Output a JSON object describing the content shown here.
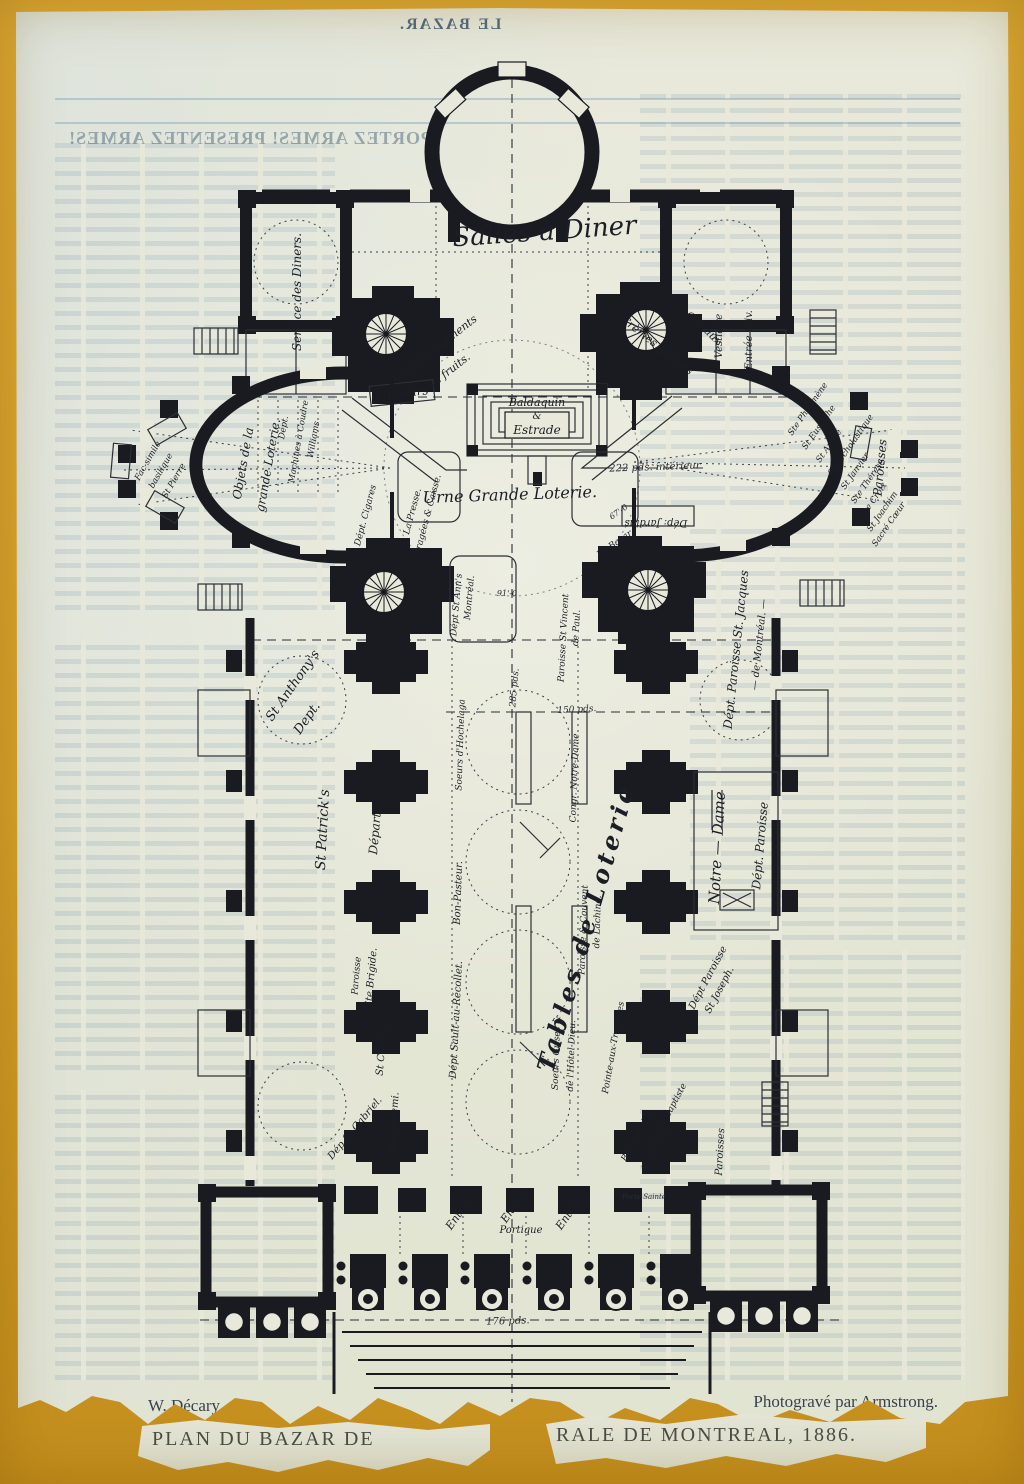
{
  "artwork": {
    "ghost_masthead": "LE BAZAR.",
    "ghost_headline": "PORTEZ ARMES! PRESENTEZ ARMES!",
    "caption": {
      "artist": "W. Décary.",
      "credit": "Photogravé par Armstrong.",
      "title_left": "PLAN DU BAZAR DE",
      "title_right": "RALE DE MONTREAL, 1886."
    }
  },
  "colors": {
    "board": "#d6a22b",
    "paper": "#e8e9da",
    "ink": "#191b21",
    "ghost_text": "#6d94ad"
  },
  "plan": {
    "labels": [
      {
        "id": "salles-a-diner",
        "t": "Salles à Diner",
        "x": 545,
        "y": 240,
        "r": -4,
        "s": 26
      },
      {
        "id": "service-des-diners",
        "t": "Service des Diners.",
        "x": 301,
        "y": 292,
        "r": -90,
        "s": 12
      },
      {
        "id": "rafraichissements",
        "t": "Rafraîchissements",
        "x": 437,
        "y": 352,
        "r": -38,
        "s": 11
      },
      {
        "id": "et-fruits",
        "t": "et fruits.",
        "x": 452,
        "y": 373,
        "r": -38,
        "s": 11
      },
      {
        "id": "liqueurs",
        "t": "Liqueurs",
        "x": 402,
        "y": 397,
        "r": -6,
        "s": 12
      },
      {
        "id": "cremes-glacees",
        "t": "Crèmes glacées",
        "x": 655,
        "y": 348,
        "r": 38,
        "s": 11
      },
      {
        "id": "gateaux",
        "t": "gâteaux",
        "x": 702,
        "y": 330,
        "r": 45,
        "s": 11
      },
      {
        "id": "vestiaire",
        "t": "Vestiaire",
        "x": 722,
        "y": 336,
        "r": -90,
        "s": 10
      },
      {
        "id": "entree-privee",
        "t": "Entrée priv.",
        "x": 752,
        "y": 340,
        "r": -90,
        "s": 10
      },
      {
        "id": "baldaquin",
        "t": "Baldaquin",
        "x": 537,
        "y": 406,
        "r": 0,
        "s": 11
      },
      {
        "id": "baldaquin-et",
        "t": "&",
        "x": 537,
        "y": 419,
        "r": 0,
        "s": 10
      },
      {
        "id": "estrade",
        "t": "Estrade",
        "x": 537,
        "y": 434,
        "r": 0,
        "s": 12
      },
      {
        "id": "dim-222",
        "t": "222 pds. intérieur",
        "x": 655,
        "y": 470,
        "r": -2,
        "s": 10,
        "c": "dim"
      },
      {
        "id": "urne-grande-loterie",
        "t": "Urne Grande Loterie.",
        "x": 510,
        "y": 500,
        "r": -2,
        "s": 16
      },
      {
        "id": "facsimile-1",
        "t": "Fac-simile",
        "x": 150,
        "y": 462,
        "r": -60,
        "s": 8.5
      },
      {
        "id": "facsimile-2",
        "t": "basilique",
        "x": 163,
        "y": 472,
        "r": -60,
        "s": 8.5
      },
      {
        "id": "facsimile-3",
        "t": "St Pierre",
        "x": 176,
        "y": 482,
        "r": -60,
        "s": 8.5
      },
      {
        "id": "objets-1",
        "t": "Objets de la",
        "x": 247,
        "y": 464,
        "r": -80,
        "s": 12
      },
      {
        "id": "objets-2",
        "t": "grande Loterie.",
        "x": 272,
        "y": 466,
        "r": -80,
        "s": 12
      },
      {
        "id": "machines-1",
        "t": "Dépt.",
        "x": 286,
        "y": 428,
        "r": -80,
        "s": 8.5
      },
      {
        "id": "machines-2",
        "t": "Machines à Coudre",
        "x": 301,
        "y": 442,
        "r": -80,
        "s": 8.5
      },
      {
        "id": "machines-3",
        "t": "Williams",
        "x": 316,
        "y": 440,
        "r": -80,
        "s": 8.5
      },
      {
        "id": "cigares",
        "t": "Dépt. Cigares",
        "x": 368,
        "y": 516,
        "r": -75,
        "s": 9
      },
      {
        "id": "presse-1",
        "t": "La Presse.",
        "x": 415,
        "y": 512,
        "r": -75,
        "s": 9
      },
      {
        "id": "presse-2",
        "t": "Dragées & Caisse.",
        "x": 430,
        "y": 516,
        "r": -75,
        "s": 9
      },
      {
        "id": "st-anns-1",
        "t": "Dépt St Ann's",
        "x": 459,
        "y": 605,
        "r": -85,
        "s": 9
      },
      {
        "id": "st-anns-2",
        "t": "Montréal.",
        "x": 472,
        "y": 598,
        "r": -85,
        "s": 9
      },
      {
        "id": "le-bazar",
        "t": "Le Bazar",
        "x": 616,
        "y": 546,
        "r": -35,
        "s": 9
      },
      {
        "id": "dep-jardins",
        "t": "Dép: Jardins",
        "x": 656,
        "y": 520,
        "r": 180,
        "s": 10
      },
      {
        "id": "dim-67",
        "t": "67'-0",
        "x": 620,
        "y": 514,
        "r": -35,
        "s": 8,
        "c": "dim"
      },
      {
        "id": "dim-91",
        "t": "91'-0",
        "x": 507,
        "y": 596,
        "r": 0,
        "s": 8,
        "c": "dim"
      },
      {
        "id": "paroisses-right",
        "t": "Paroisses",
        "x": 884,
        "y": 468,
        "r": -85,
        "s": 12
      },
      {
        "id": "paroisse-1",
        "t": "Ste Philomène",
        "x": 792,
        "y": 436,
        "r": -55,
        "s": 8.5,
        "a": "s"
      },
      {
        "id": "paroisse-2",
        "t": "St Eustache",
        "x": 806,
        "y": 450,
        "r": -55,
        "s": 8.5,
        "a": "s"
      },
      {
        "id": "paroisse-3",
        "t": "St André",
        "x": 820,
        "y": 463,
        "r": -55,
        "s": 8.5,
        "a": "s"
      },
      {
        "id": "paroisse-4",
        "t": "Ste Scholastique",
        "x": 832,
        "y": 476,
        "r": -55,
        "s": 8.5,
        "a": "s"
      },
      {
        "id": "paroisse-5",
        "t": "St Janvier",
        "x": 845,
        "y": 490,
        "r": -55,
        "s": 8.5,
        "a": "s"
      },
      {
        "id": "paroisse-6",
        "t": "Ste Thérèse",
        "x": 855,
        "y": 504,
        "r": -55,
        "s": 8.5,
        "a": "s"
      },
      {
        "id": "paroisse-7",
        "t": "Ste Croix",
        "x": 864,
        "y": 518,
        "r": -55,
        "s": 8.5,
        "a": "s"
      },
      {
        "id": "paroisse-8",
        "t": "St Joachim",
        "x": 871,
        "y": 532,
        "r": -55,
        "s": 8.5,
        "a": "s"
      },
      {
        "id": "paroisse-9",
        "t": "Sacré Cœur",
        "x": 876,
        "y": 547,
        "r": -55,
        "s": 8.5,
        "a": "s"
      },
      {
        "id": "dim-285",
        "t": "285 pds.",
        "x": 517,
        "y": 688,
        "r": -85,
        "s": 9,
        "c": "dim"
      },
      {
        "id": "dim-150",
        "t": "150 pds.",
        "x": 577,
        "y": 712,
        "r": -3,
        "s": 9,
        "c": "dim"
      },
      {
        "id": "st-vincent-1",
        "t": "Paroisse St Vincent",
        "x": 566,
        "y": 638,
        "r": -87,
        "s": 9
      },
      {
        "id": "st-vincent-2",
        "t": "de Paul.",
        "x": 579,
        "y": 628,
        "r": -87,
        "s": 9
      },
      {
        "id": "st-jacques-1",
        "t": "Dépt. Paroisse St. Jacques",
        "x": 740,
        "y": 650,
        "r": -84,
        "s": 12
      },
      {
        "id": "st-jacques-2",
        "t": "— de Montréal. —",
        "x": 762,
        "y": 645,
        "r": -84,
        "s": 10
      },
      {
        "id": "st-anthonys-1",
        "t": "St Anthony's",
        "x": 272,
        "y": 722,
        "r": -55,
        "s": 13,
        "a": "s"
      },
      {
        "id": "st-anthonys-2",
        "t": "Dept.",
        "x": 300,
        "y": 735,
        "r": -55,
        "s": 13,
        "a": "s"
      },
      {
        "id": "soeurs-hochelaga",
        "t": "Soeurs d'Hochelaga",
        "x": 463,
        "y": 745,
        "r": -88,
        "s": 9
      },
      {
        "id": "congr-notre-dame",
        "t": "Congr. Notre-Dame",
        "x": 577,
        "y": 778,
        "r": -88,
        "s": 9
      },
      {
        "id": "st-patricks",
        "t": "St Patrick's",
        "x": 327,
        "y": 830,
        "r": -87,
        "s": 14
      },
      {
        "id": "depart",
        "t": "Départ.",
        "x": 379,
        "y": 832,
        "r": -85,
        "s": 12
      },
      {
        "id": "bon-pasteur",
        "t": "Bon-Pasteur.",
        "x": 461,
        "y": 893,
        "r": -88,
        "s": 10
      },
      {
        "id": "tables-de-loterie",
        "t": "Tables de Loterie",
        "x": 594,
        "y": 930,
        "r": -74,
        "s": 24,
        "c": "big"
      },
      {
        "id": "notre-dame",
        "t": "Notre — Dame",
        "x": 722,
        "y": 848,
        "r": -87,
        "s": 15
      },
      {
        "id": "dept-paroisse-nd",
        "t": "Dépt. Paroisse",
        "x": 764,
        "y": 846,
        "r": -85,
        "s": 12
      },
      {
        "id": "lachine-1",
        "t": "Paroisse & Couvent",
        "x": 586,
        "y": 930,
        "r": -88,
        "s": 9
      },
      {
        "id": "lachine-2",
        "t": "de Lachine.",
        "x": 600,
        "y": 922,
        "r": -88,
        "s": 9
      },
      {
        "id": "ste-brigide-1",
        "t": "Paroisse",
        "x": 359,
        "y": 976,
        "r": -85,
        "s": 9
      },
      {
        "id": "ste-brigide-2",
        "t": "Ste Brigide.",
        "x": 374,
        "y": 978,
        "r": -85,
        "s": 10
      },
      {
        "id": "st-charles",
        "t": "St Charles.",
        "x": 385,
        "y": 1048,
        "r": -85,
        "s": 10
      },
      {
        "id": "sault-au-recollet",
        "t": "Dépt Sault-au-Récollet.",
        "x": 459,
        "y": 1020,
        "r": -87,
        "s": 10
      },
      {
        "id": "st-joseph-1",
        "t": "Dépt Paroisse",
        "x": 694,
        "y": 1010,
        "r": -62,
        "s": 10,
        "a": "s"
      },
      {
        "id": "st-joseph-2",
        "t": "St Joseph.",
        "x": 710,
        "y": 1014,
        "r": -62,
        "s": 10,
        "a": "s"
      },
      {
        "id": "soeurs-grises-1",
        "t": "Soeurs Grises &",
        "x": 559,
        "y": 1053,
        "r": -88,
        "s": 9
      },
      {
        "id": "soeurs-grises-2",
        "t": "de l'Hôtel-Dieu.",
        "x": 574,
        "y": 1056,
        "r": -88,
        "s": 9
      },
      {
        "id": "pointe-aux-trembles",
        "t": "Pointe-aux-Trembles",
        "x": 616,
        "y": 1048,
        "r": -80,
        "s": 9
      },
      {
        "id": "st-jean-baptiste",
        "t": "St Jean Baptiste",
        "x": 652,
        "y": 1150,
        "r": -62,
        "s": 9,
        "a": "s"
      },
      {
        "id": "berthierville",
        "t": "Berthierville",
        "x": 626,
        "y": 1162,
        "r": -62,
        "s": 9,
        "a": "s"
      },
      {
        "id": "chambly",
        "t": "& Chambly",
        "x": 646,
        "y": 1172,
        "r": -62,
        "s": 9,
        "a": "s"
      },
      {
        "id": "dep-st-gabriel",
        "t": "Dép St Gabriel.",
        "x": 332,
        "y": 1160,
        "r": -50,
        "s": 10,
        "a": "s"
      },
      {
        "id": "barthelemi",
        "t": "Barthélemi.",
        "x": 397,
        "y": 1122,
        "r": -87,
        "s": 10
      },
      {
        "id": "paroisses-bottom",
        "t": "Paroisses",
        "x": 723,
        "y": 1152,
        "r": -87,
        "s": 10
      },
      {
        "id": "entree-1",
        "t": "Entrée",
        "x": 462,
        "y": 1215,
        "r": -55,
        "s": 11
      },
      {
        "id": "entree-2",
        "t": "Entrée",
        "x": 517,
        "y": 1208,
        "r": -55,
        "s": 11
      },
      {
        "id": "entree-3",
        "t": "Entrée",
        "x": 572,
        "y": 1215,
        "r": -55,
        "s": 11
      },
      {
        "id": "portique",
        "t": "Portique",
        "x": 521,
        "y": 1233,
        "r": 0,
        "s": 10
      },
      {
        "id": "porte-sainte",
        "t": "Porte Sainte",
        "x": 644,
        "y": 1199,
        "r": 0,
        "s": 7,
        "c": "dim"
      },
      {
        "id": "dim-176",
        "t": "176 pds.",
        "x": 508,
        "y": 1324,
        "r": -2,
        "s": 10,
        "c": "dim"
      }
    ]
  }
}
